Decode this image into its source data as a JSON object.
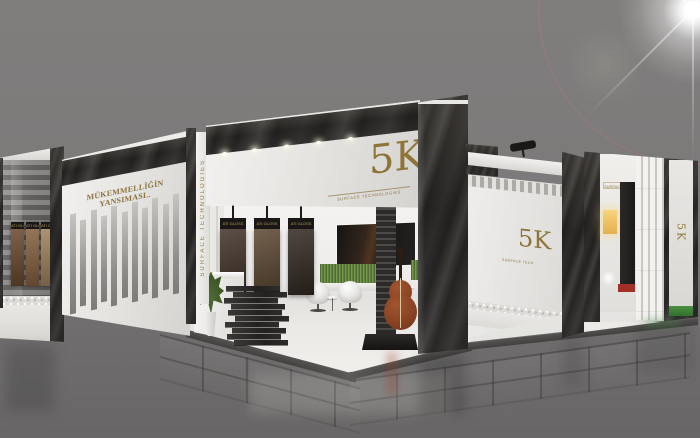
{
  "scene": {
    "description": "3D render of the 5K Surface Technologies exhibition stand on a grey hall floor with a lens flare",
    "background_color": "#7b7979",
    "gold": "#97793c",
    "marble_black": "#23211f",
    "platform_white": "#f2f1ef"
  },
  "branding": {
    "logo_text": "5K",
    "tagline": "SURFACE TECHNOLOGIES",
    "slogan": "MÜKEMMELLİĞİN YANSIMASI.."
  },
  "left_case": {
    "labels": [
      "ATI GLOSS",
      "ATI GLOSS",
      "ATI GLOSS"
    ],
    "colors": [
      "#6e4c2f",
      "#8a6542",
      "#a8875f"
    ],
    "x": [
      11,
      26,
      41
    ]
  },
  "left_wing": {
    "slat_count": 11
  },
  "hanging_panels": {
    "labels": [
      "ATI GLOSS",
      "ATI GLOSS",
      "ATI GLOSS"
    ],
    "colors": [
      "#42332a",
      "#5d4832",
      "#332a22"
    ],
    "x": [
      26,
      60,
      94
    ]
  },
  "ceiling": {
    "light_count": 5,
    "light_x": [
      16,
      46,
      78,
      110,
      142
    ]
  },
  "stack": {
    "slab_offsets": [
      2,
      9,
      0,
      7,
      4,
      11,
      1,
      8,
      3,
      10
    ]
  },
  "right_wall": {
    "logo_text": "5K",
    "tagline": "SURFACE TECHNOLOGIES",
    "tile_colors": [
      "#6e4c2f",
      "#8f6c44",
      "#c9bead",
      "#ece9e1",
      "#9b7a52",
      "#3f2f22",
      "#402e20",
      "#7c5837",
      "#56422e",
      "#f0ede7",
      "#8f6c44",
      "#6e4c2f",
      "#7c5837",
      "#4a3726",
      "#8f6c44",
      "#e9e6de",
      "#6e4c2f",
      "#9b7a52",
      "#56422e",
      "#9b7a52",
      "#402e20",
      "#efece6",
      "#7c5837",
      "#4a3726",
      "#8f6c44",
      "#6e4c2f",
      "#7c5837",
      "#e9e6de",
      "#56422e",
      "#8f6c44"
    ]
  },
  "right_end": {
    "plate_text": "SURFACE TECHNOLOGIES",
    "logo_text": "5K"
  },
  "desk": {
    "logo_text": "5K"
  }
}
